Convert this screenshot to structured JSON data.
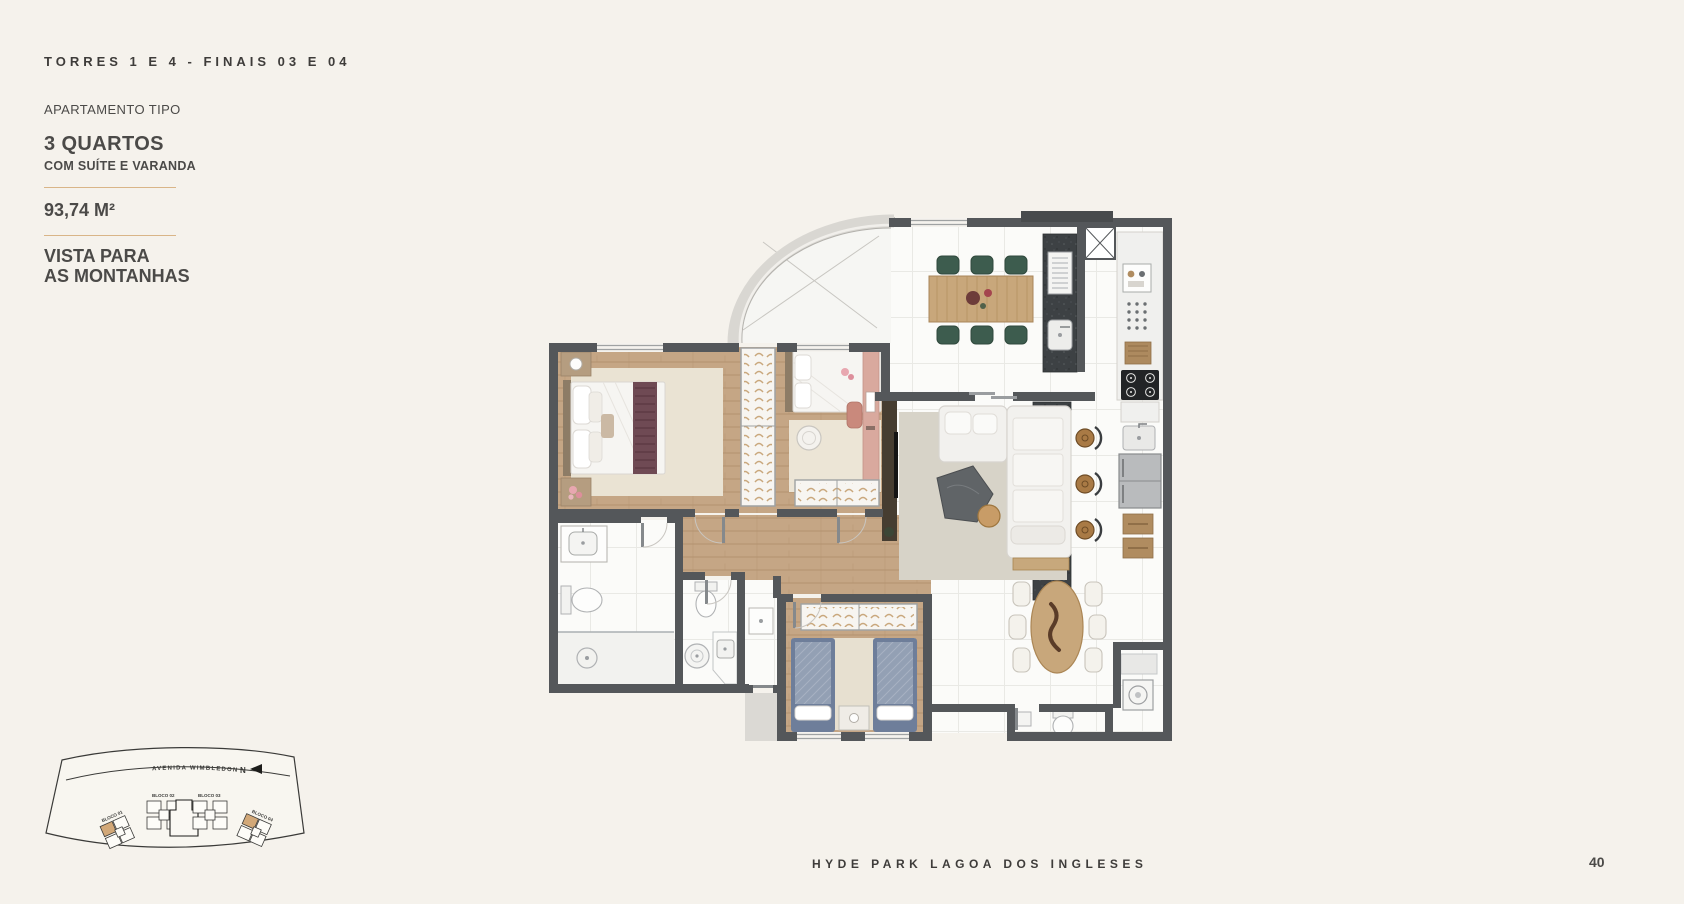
{
  "header": {
    "kicker": "TORRES 1 E 4 - FINAIS 03 E 04"
  },
  "info_panel": {
    "label": "APARTAMENTO TIPO",
    "title": "3 QUARTOS",
    "subtitle": "COM SUÍTE E VARANDA",
    "area": "93,74 M²",
    "view_line1": "VISTA PARA",
    "view_line2": "AS MONTANHAS"
  },
  "site_map": {
    "street_label": "AVENIDA WIMBLEDON",
    "north_label": "N",
    "blocks": [
      {
        "label": "BLOCO 01",
        "highlighted": true
      },
      {
        "label": "BLOCO 02",
        "highlighted": false
      },
      {
        "label": "BLOCO 03",
        "highlighted": false
      },
      {
        "label": "BLOCO 04",
        "highlighted": true
      }
    ]
  },
  "footer": {
    "project_name": "HYDE PARK LAGOA DOS INGLESES",
    "page_number": "40"
  },
  "theme": {
    "page_bg": "#f5f2ec",
    "ink": "#4b4a48",
    "ink_dark": "#3e3c3a",
    "gold": "#d9b588",
    "wall": "#54575a",
    "wood": "#c5a685",
    "marble": "#fbfbf9",
    "granite": "#3d4144",
    "rug_beige": "#eae3d3",
    "rug_gray": "#d7d3c8",
    "green_chair": "#3d5c4e",
    "maroon": "#6f4a54",
    "blue_bed": "#93a0b4",
    "salmon": "#d9a99e",
    "tan_wood": "#c8a77b",
    "curve_band": "#d9d7d2",
    "highlight_unit": "#d2a878"
  }
}
